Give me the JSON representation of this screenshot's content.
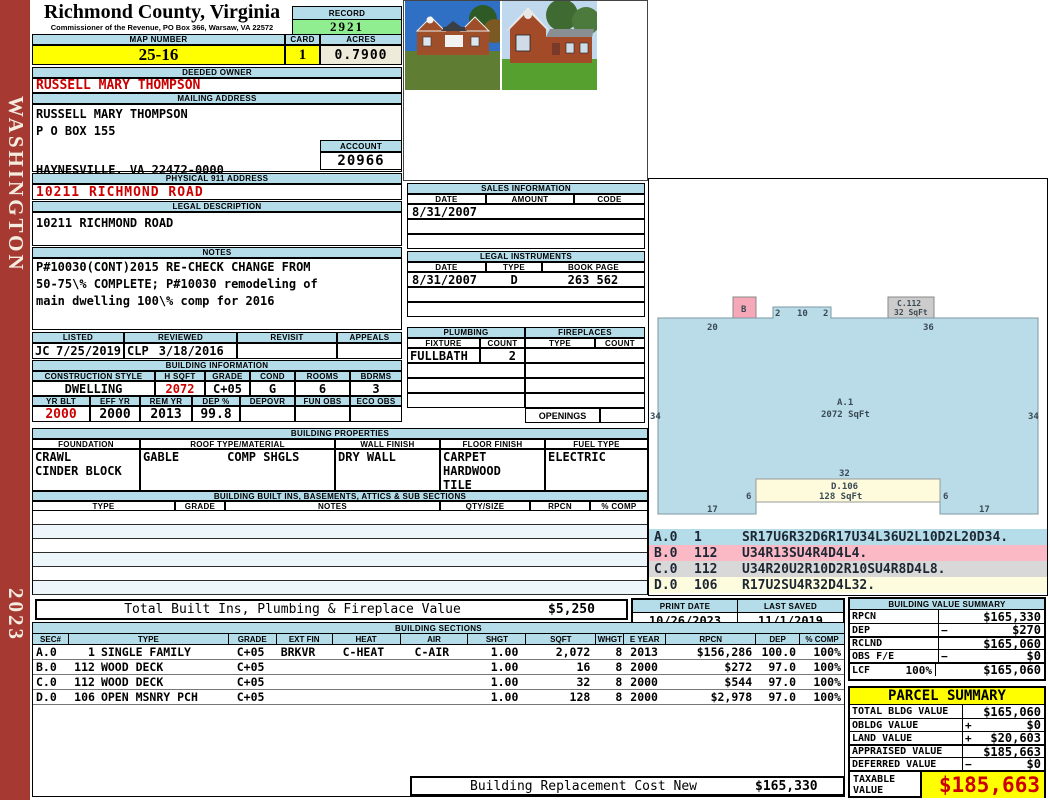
{
  "sidebar": {
    "district": "WASHINGTON",
    "year": "2023"
  },
  "header": {
    "county_title": "Richmond County, Virginia",
    "commissioner_line": "Commissioner of the Revenue, PO Box 366, Warsaw, VA 22572",
    "record_label": "RECORD",
    "record_value": "2921",
    "map_number_label": "MAP NUMBER",
    "map_number": "25-16",
    "card_label": "CARD",
    "card": "1",
    "acres_label": "ACRES",
    "acres": "0.7900"
  },
  "owner": {
    "deeded_owner_label": "DEEDED OWNER",
    "deeded_owner": "RUSSELL MARY THOMPSON",
    "mailing_address_label": "MAILING ADDRESS",
    "mailing_line1": "RUSSELL MARY THOMPSON",
    "mailing_line2": "P O BOX 155",
    "mailing_line3": "HAYNESVILLE, VA 22472-0000",
    "account_label": "ACCOUNT",
    "account": "20966",
    "physical_address_label": "PHYSICAL 911 ADDRESS",
    "physical_address": "10211 RICHMOND ROAD",
    "legal_description_label": "LEGAL DESCRIPTION",
    "legal_description": "10211 RICHMOND ROAD"
  },
  "notes": {
    "label": "NOTES",
    "line1": "P#10030(CONT)2015 RE-CHECK CHANGE FROM",
    "line2": "50-75\\% COMPLETE; P#10030 remodeling of",
    "line3": "main dwelling 100\\% comp for 2016"
  },
  "review": {
    "listed_label": "LISTED",
    "listed_by": "JC",
    "listed_date": "7/25/2019",
    "reviewed_label": "REVIEWED",
    "reviewed_by": "CLP",
    "reviewed_date": "3/18/2016",
    "revisit_label": "REVISIT",
    "revisit": "",
    "appeals_label": "APPEALS",
    "appeals": ""
  },
  "building_information": {
    "label": "BUILDING INFORMATION",
    "style_label": "CONSTRUCTION STYLE",
    "style": "DWELLING",
    "hsqft_label": "H SQFT",
    "hsqft": "2072",
    "grade_label": "GRADE",
    "grade": "C+05",
    "cond_label": "COND",
    "cond": "G",
    "rooms_label": "ROOMS",
    "rooms": "6",
    "bdrms_label": "BDRMS",
    "bdrms": "3",
    "yrblt_label": "YR BLT",
    "yrblt": "2000",
    "effyr_label": "EFF YR",
    "effyr": "2000",
    "remyr_label": "REM YR",
    "remyr": "2013",
    "dep_label": "DEP %",
    "dep": "99.8",
    "depovr_label": "DEPOVR",
    "depovr": "",
    "funobs_label": "FUN OBS",
    "funobs": "",
    "ecoobs_label": "ECO OBS",
    "ecoobs": ""
  },
  "sales": {
    "label": "SALES INFORMATION",
    "date_h": "DATE",
    "amount_h": "AMOUNT",
    "code_h": "CODE",
    "row1_date": "8/31/2007",
    "row1_amount": "",
    "row1_code": ""
  },
  "instruments": {
    "label": "LEGAL INSTRUMENTS",
    "date_h": "DATE",
    "type_h": "TYPE",
    "book_h": "BOOK PAGE",
    "row1_date": "8/31/2007",
    "row1_type": "D",
    "row1_book": "263 562"
  },
  "plumbing": {
    "label": "PLUMBING",
    "fixture_h": "FIXTURE",
    "count_h": "COUNT",
    "row1_fixture": "FULLBATH",
    "row1_count": "2"
  },
  "fireplaces": {
    "label": "FIREPLACES",
    "type_h": "TYPE",
    "count_h": "COUNT",
    "openings_label": "OPENINGS"
  },
  "properties": {
    "label": "BUILDING PROPERTIES",
    "foundation_h": "FOUNDATION",
    "foundation1": "CRAWL",
    "foundation2": "CINDER BLOCK",
    "roof_h": "ROOF TYPE/MATERIAL",
    "roof_type": "GABLE",
    "roof_material": "COMP SHGLS",
    "wall_h": "WALL FINISH",
    "wall": "DRY WALL",
    "floor_h": "FLOOR FINISH",
    "floor1": "CARPET",
    "floor2": "HARDWOOD",
    "floor3": "TILE",
    "fuel_h": "FUEL TYPE",
    "fuel": "ELECTRIC"
  },
  "builtins": {
    "label": "BUILDING BUILT INS, BASEMENTS, ATTICS & SUB SECTIONS",
    "headers": [
      "TYPE",
      "GRADE",
      "NOTES",
      "QTY/SIZE",
      "RPCN",
      "% COMP"
    ],
    "total_label": "Total Built Ins, Plumbing & Fireplace Value",
    "total_value": "$5,250"
  },
  "sketch": {
    "a_label": "A.1",
    "a_sqft": "2072 SqFt",
    "b_label": "B",
    "c_label": "C.112",
    "c_sqft": "32 SqFt",
    "d_label": "D.106",
    "d_sqft": "128 SqFt",
    "dim_top_left": "20",
    "dim_bump_l": "2",
    "dim_bump_m": "10",
    "dim_bump_r": "2",
    "dim_top_right": "36",
    "dim_left": "34",
    "dim_right": "34",
    "dim_porch_top": "32",
    "dim_porch_l": "6",
    "dim_porch_r": "6",
    "dim_bottom_l": "17",
    "dim_bottom_r": "17"
  },
  "vectors": [
    {
      "sec": "A.0",
      "code": "1",
      "path": "SR17U6R32D6R17U34L36U2L10D2L20D34."
    },
    {
      "sec": "B.0",
      "code": "112",
      "path": "U34R13SU4R4D4L4."
    },
    {
      "sec": "C.0",
      "code": "112",
      "path": "U34R20U2R10D2R10SU4R8D4L8."
    },
    {
      "sec": "D.0",
      "code": "106",
      "path": "R17U2SU4R32D4L32."
    }
  ],
  "print_block": {
    "print_label": "PRINT DATE",
    "print_date": "10/26/2023",
    "saved_label": "LAST SAVED",
    "saved_date": "11/1/2019"
  },
  "bvs": {
    "label": "BUILDING VALUE SUMMARY",
    "rows": [
      {
        "label": "RPCN",
        "sign": "",
        "value": "$165,330"
      },
      {
        "label": "DEP",
        "sign": "−",
        "value": "$270"
      },
      {
        "label": "RCLND",
        "sign": "",
        "value": "$165,060"
      },
      {
        "label": "OBS F/E",
        "sign": "−",
        "value": "$0"
      },
      {
        "label": "LCF",
        "extra": "100%",
        "sign": "",
        "value": "$165,060"
      }
    ]
  },
  "sections": {
    "label": "BUILDING SECTIONS",
    "headers": [
      "SEC#",
      "TYPE",
      "GRADE",
      "EXT FIN",
      "HEAT",
      "AIR",
      "SHGT",
      "SQFT",
      "WHGT",
      "E YEAR",
      "RPCN",
      "DEP",
      "% COMP"
    ],
    "rows": [
      {
        "sec": "A.0",
        "code": "1",
        "type": "SINGLE FAMILY",
        "grade": "C+05",
        "ext": "BRKVR",
        "heat": "C-HEAT",
        "air": "C-AIR",
        "shgt": "1.00",
        "sqft": "2,072",
        "whgt": "8",
        "eyear": "2013",
        "rpcn": "$156,286",
        "dep": "100.0",
        "comp": "100%"
      },
      {
        "sec": "B.0",
        "code": "112",
        "type": "WOOD DECK",
        "grade": "C+05",
        "ext": "",
        "heat": "",
        "air": "",
        "shgt": "1.00",
        "sqft": "16",
        "whgt": "8",
        "eyear": "2000",
        "rpcn": "$272",
        "dep": "97.0",
        "comp": "100%"
      },
      {
        "sec": "C.0",
        "code": "112",
        "type": "WOOD DECK",
        "grade": "C+05",
        "ext": "",
        "heat": "",
        "air": "",
        "shgt": "1.00",
        "sqft": "32",
        "whgt": "8",
        "eyear": "2000",
        "rpcn": "$544",
        "dep": "97.0",
        "comp": "100%"
      },
      {
        "sec": "D.0",
        "code": "106",
        "type": "OPEN MSNRY PCH",
        "grade": "C+05",
        "ext": "",
        "heat": "",
        "air": "",
        "shgt": "1.00",
        "sqft": "128",
        "whgt": "8",
        "eyear": "2000",
        "rpcn": "$2,978",
        "dep": "97.0",
        "comp": "100%"
      }
    ]
  },
  "replacement": {
    "label": "Building Replacement Cost New",
    "value": "$165,330"
  },
  "parcel": {
    "label": "PARCEL SUMMARY",
    "rows": [
      {
        "label": "TOTAL BLDG VALUE",
        "sign": "",
        "value": "$165,060"
      },
      {
        "label": "OBLDG VALUE",
        "sign": "+",
        "value": "$0"
      },
      {
        "label": "LAND VALUE",
        "sign": "+",
        "value": "$20,603"
      },
      {
        "label": "APPRAISED VALUE",
        "sign": "",
        "value": "$185,663"
      },
      {
        "label": "DEFERRED VALUE",
        "sign": "−",
        "value": "$0"
      }
    ],
    "taxable_label": "TAXABLE VALUE",
    "taxable_value": "$185,663"
  },
  "colors": {
    "header_blue": "#B5DCE9",
    "record_green": "#90EE90",
    "highlight_yellow": "#FFFF00",
    "acres_beige": "#EFEBDA",
    "sidebar_red": "#A63A32",
    "accent_red": "#CC0000",
    "sketch_blue": "#B9DCE8",
    "sketch_pink": "#F7A8B8",
    "sketch_gray": "#CCCCCC",
    "sketch_cream": "#FEFBDC"
  }
}
